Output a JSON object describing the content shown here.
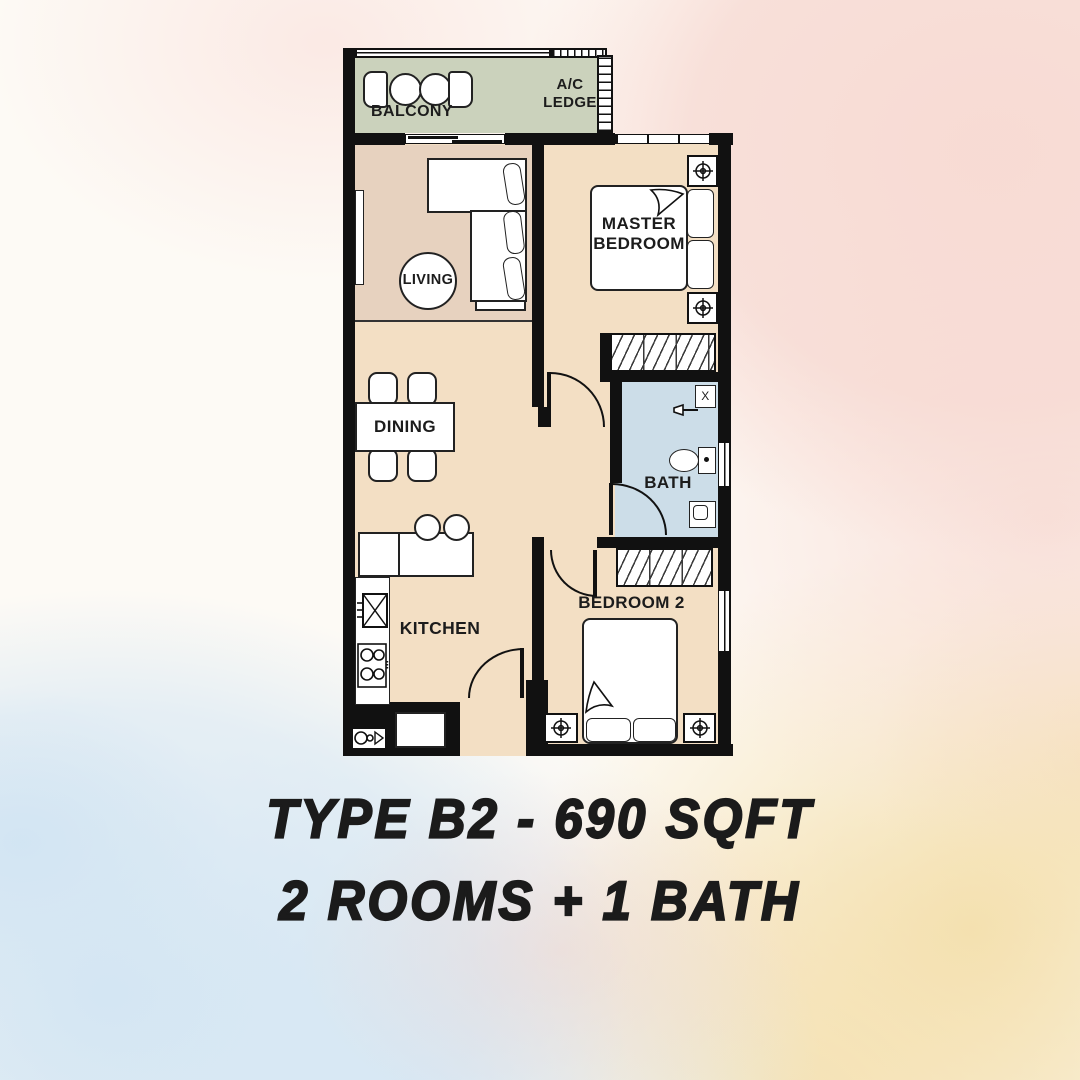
{
  "poster": {
    "title": "TYPE B2 - 690 SQFT",
    "subtitle": "2 ROOMS + 1 BATH",
    "unit_type": "B2",
    "area_sqft": "690",
    "rooms_count": "2",
    "baths_count": "1"
  },
  "floor_plan": {
    "rooms": {
      "balcony": "BALCONY",
      "ac_ledge_line1": "A/C",
      "ac_ledge_line2": "LEDGE",
      "living": "LIVING",
      "master_line1": "MASTER",
      "master_line2": "BEDROOM",
      "dining": "DINING",
      "bath": "BATH",
      "kitchen": "KITCHEN",
      "bedroom2": "BEDROOM 2"
    },
    "markers": {
      "heater": "X"
    },
    "colors": {
      "wall": "#111111",
      "floor": "#f3dfc4",
      "living_floor": "#e7d2bf",
      "balcony_floor": "#cbd2bc",
      "bath_floor": "#ccdde8",
      "background_pink": "#f7d9d2",
      "background_blue": "#d2e5f3",
      "background_sand": "#f3ddA6",
      "text": "#1c1c1c"
    }
  }
}
